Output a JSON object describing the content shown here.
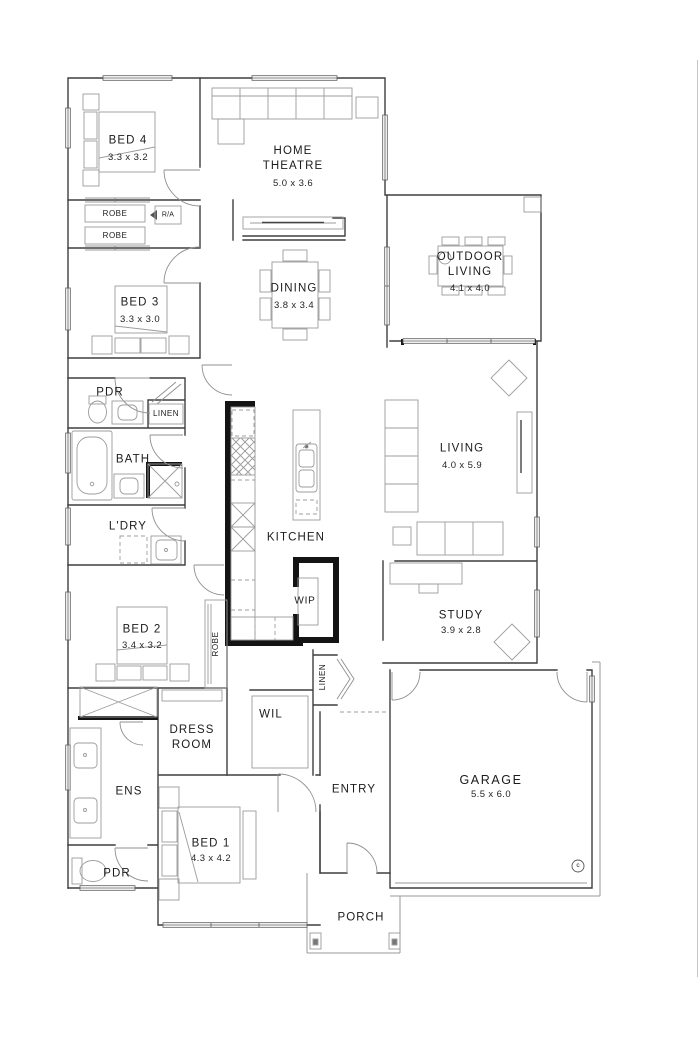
{
  "rooms": [
    {
      "name": "BED 4",
      "dims": "3.3 x 3.2"
    },
    {
      "name": "HOME THEATRE",
      "dims": "5.0 x 3.6"
    },
    {
      "name": "BED 3",
      "dims": "3.3 x 3.0"
    },
    {
      "name": "DINING",
      "dims": "3.8 x 3.4"
    },
    {
      "name": "OUTDOOR LIVING",
      "dims": "4.1 x 4.0"
    },
    {
      "name": "LIVING",
      "dims": "4.0 x 5.9"
    },
    {
      "name": "KITCHEN"
    },
    {
      "name": "WIP"
    },
    {
      "name": "STUDY",
      "dims": "3.9 x 2.8"
    },
    {
      "name": "BED 2",
      "dims": "3.4 x 3.2"
    },
    {
      "name": "BATH"
    },
    {
      "name": "L'DRY"
    },
    {
      "name": "PDR"
    },
    {
      "name": "WIL"
    },
    {
      "name": "DRESS ROOM"
    },
    {
      "name": "ENS"
    },
    {
      "name": "BED 1",
      "dims": "4.3 x 4.2"
    },
    {
      "name": "PDR"
    },
    {
      "name": "ENTRY"
    },
    {
      "name": "GARAGE",
      "dims": "5.5 x 6.0"
    },
    {
      "name": "PORCH"
    }
  ],
  "closets": {
    "robe_a": "ROBE",
    "robe_b": "ROBE",
    "return_air": "R/A",
    "linen_hall": "LINEN",
    "robe_bed2": "ROBE",
    "linen_entry": "LINEN"
  },
  "markers": {
    "column": "c"
  }
}
